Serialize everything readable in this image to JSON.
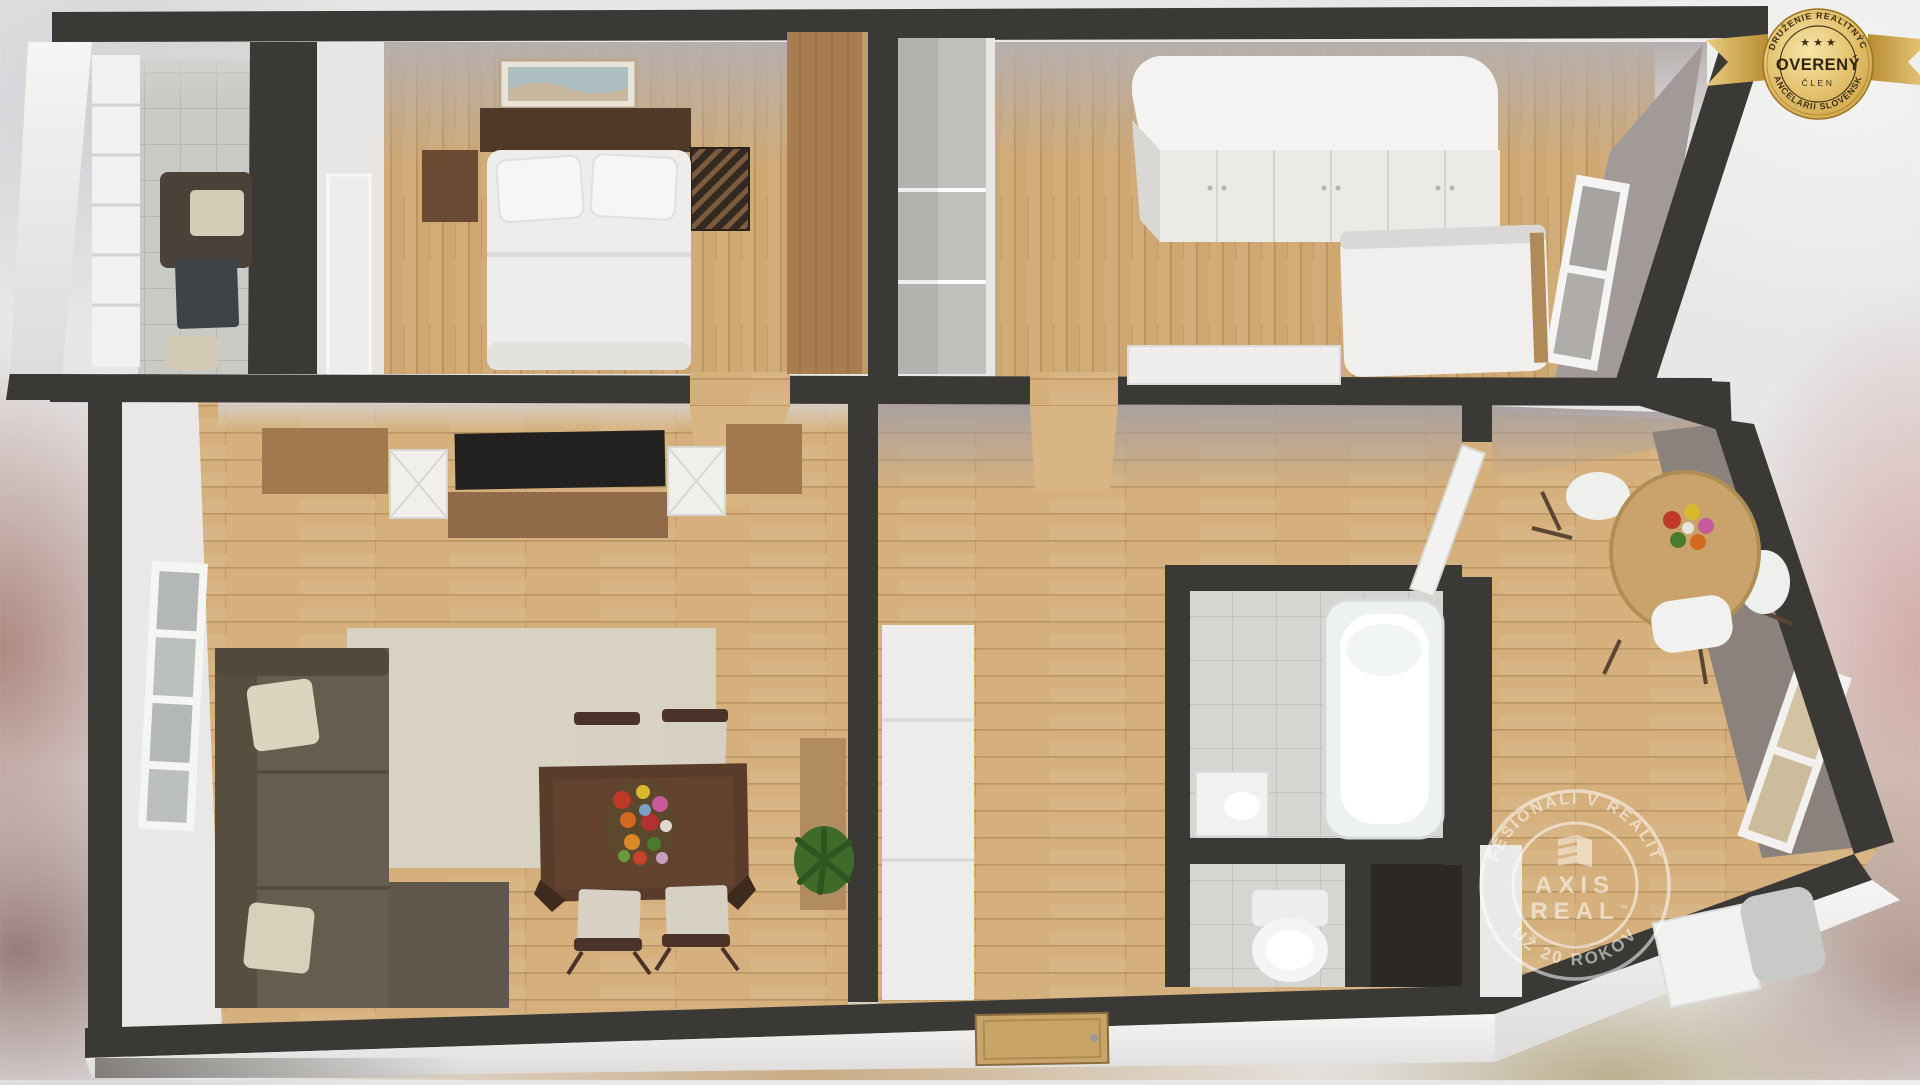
{
  "badge": {
    "arc_top": "ZDRUŽENIE REALITNÝCH",
    "arc_bottom": "KANCELÁRIÍ SLOVENSKA",
    "stars": "★ ★ ★",
    "title": "OVERENÝ",
    "subtitle": "ČLEN",
    "gold_light": "#f7e5a8",
    "gold_mid": "#dfba64",
    "gold_dark": "#a87c22",
    "text_color": "#3a2d11"
  },
  "watermark": {
    "arc_top": "PROFESIONÁLI V REALITÁCH",
    "arc_bottom": "UŽ 20 ROKOV",
    "brand_line1": "AXIS",
    "brand_line2": "REAL",
    "trademark": "™",
    "color": "#ffffff"
  },
  "scene": {
    "type": "3d-rendered-floor-plan",
    "rooms": [
      "kitchen",
      "bedroom-1",
      "entry-closet",
      "bedroom-2",
      "living-room",
      "hallway",
      "bathroom",
      "toilet",
      "storage-nook",
      "dining-room"
    ],
    "palette": {
      "wall": "#3a3936",
      "wood_floor_bedroom": "#cfa770",
      "wood_floor_living": "#d6b07c",
      "tile_floor": "#d4d4d0",
      "mauve_wall_face": "#b4adac",
      "white_wall_face": "#e9e8e6",
      "rug": "#d8d2c3",
      "sofa": "#655d4e",
      "dining_table": "#5a3c2b",
      "exterior_wall": "#f0efed",
      "entrance_door": "#c8a469"
    }
  }
}
